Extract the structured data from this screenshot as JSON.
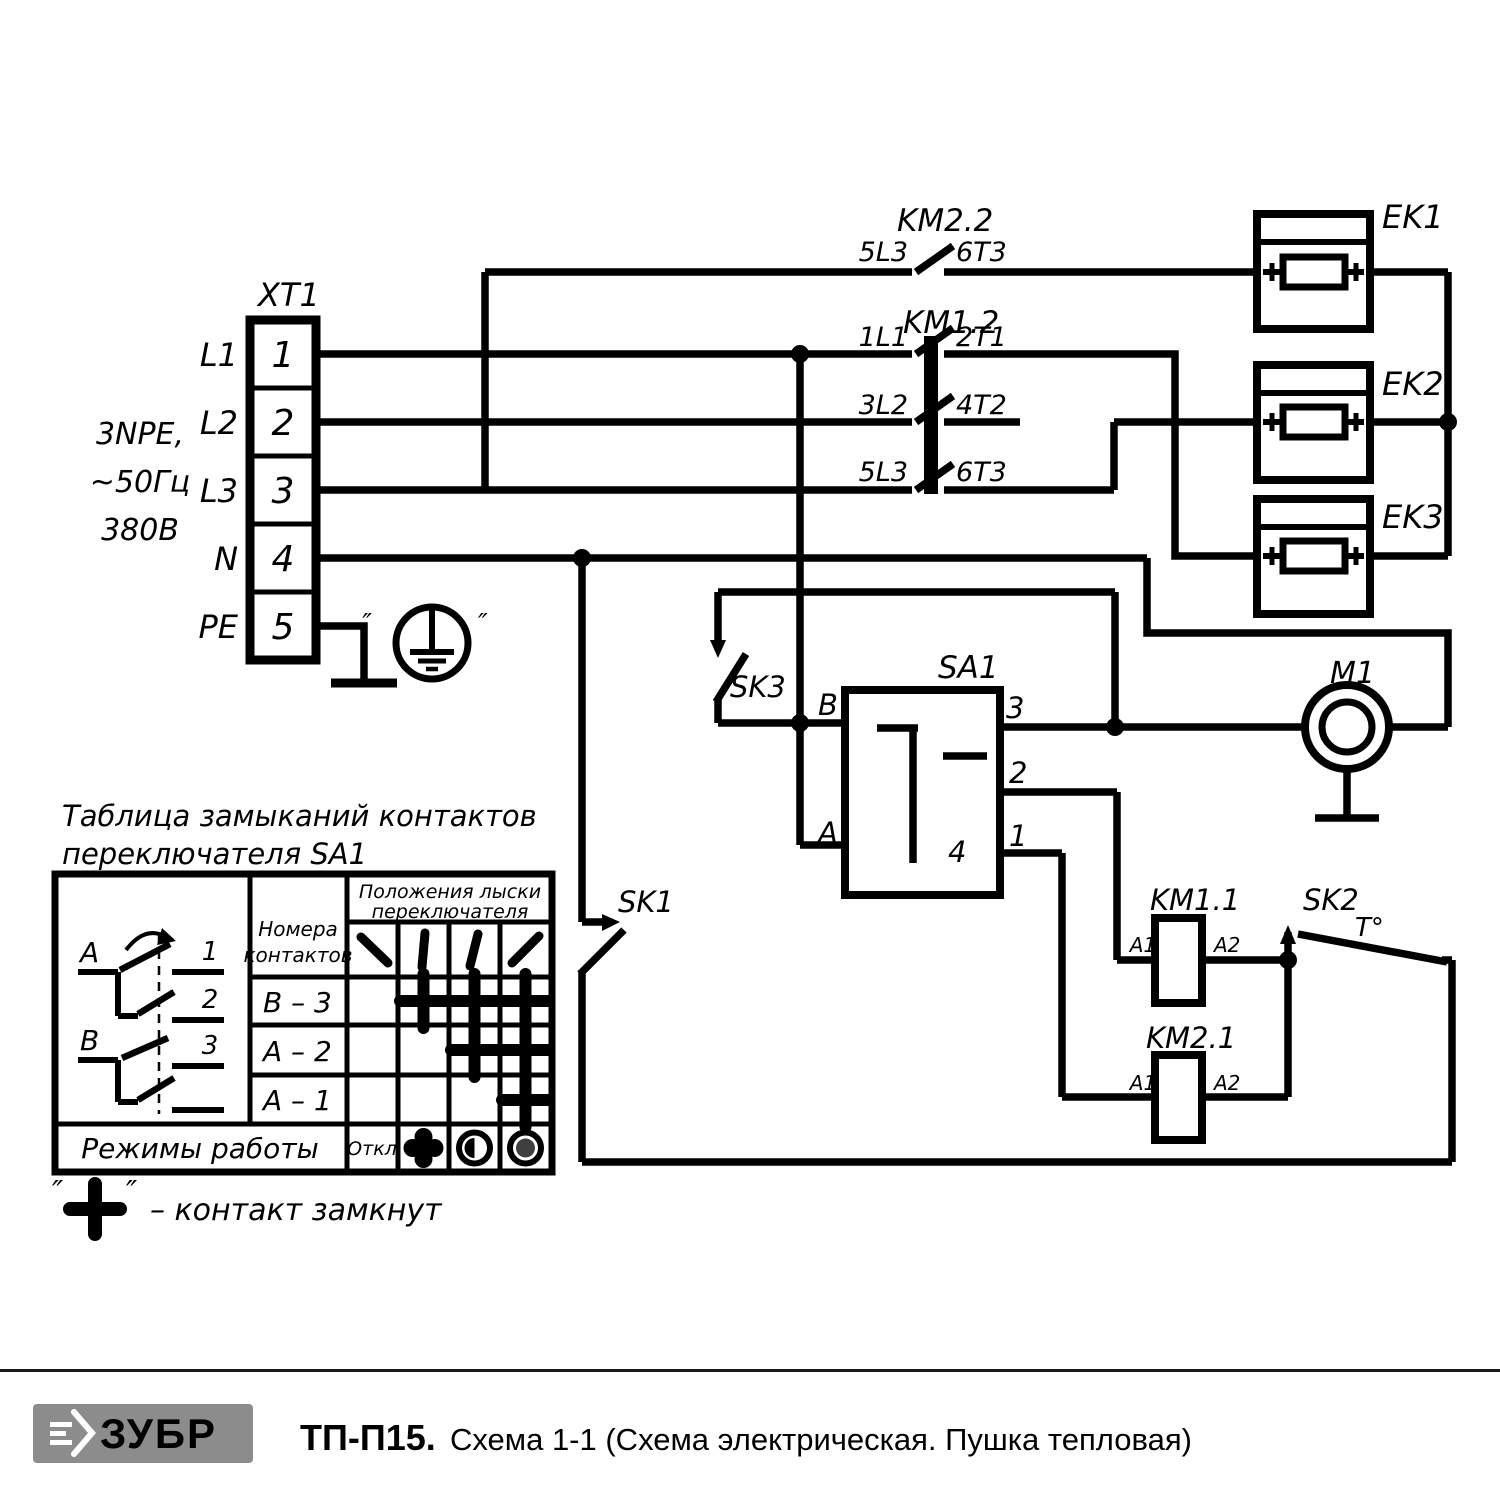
{
  "page": {
    "bg": "#ffffff",
    "ink": "#000000"
  },
  "supply": {
    "line1": "3NPE,",
    "line2": "~50Гц",
    "line3": "380В"
  },
  "xt1": {
    "name": "XT1",
    "numbers": [
      "1",
      "2",
      "3",
      "4",
      "5"
    ],
    "labels": [
      "L1",
      "L2",
      "L3",
      "N",
      "PE"
    ]
  },
  "ground": {
    "quote_open": "″",
    "quote_close": "″"
  },
  "km22": {
    "name": "KM2.2",
    "in": "5L3",
    "out": "6T3"
  },
  "km12": {
    "name": "KM1.2",
    "rows": [
      {
        "in": "1L1",
        "out": "2T1"
      },
      {
        "in": "3L2",
        "out": "4T2"
      },
      {
        "in": "5L3",
        "out": "6T3"
      }
    ]
  },
  "heaters": {
    "ek1": "EK1",
    "ek2": "EK2",
    "ek3": "EK3"
  },
  "sa1": {
    "name": "SA1",
    "b": "B",
    "a": "A",
    "t3": "3",
    "t2": "2",
    "t1": "1",
    "t4": "4"
  },
  "switches": {
    "sk1": "SK1",
    "sk2": "SK2",
    "sk2_temp": "T°",
    "sk3": "SK3"
  },
  "motor": {
    "name": "M1"
  },
  "km11": {
    "name": "KM1.1",
    "a1": "A1",
    "a2": "A2"
  },
  "km21": {
    "name": "KM2.1",
    "a1": "A1",
    "a2": "A2"
  },
  "table": {
    "title1": "Таблица замыканий контактов",
    "title2": "переключателя SA1",
    "contacts_header1": "Номера",
    "contacts_header2": "контактов",
    "positions_header1": "Положения лыски",
    "positions_header2": "переключателя",
    "rows": [
      {
        "label": "B – 3",
        "closed_positions": [
          2,
          3,
          4
        ]
      },
      {
        "label": "A – 2",
        "closed_positions": [
          3,
          4
        ]
      },
      {
        "label": "A – 1",
        "closed_positions": [
          4
        ]
      }
    ],
    "modes_label": "Режимы работы",
    "mode_off": "Откл",
    "diagram": {
      "a": "A",
      "b": "B",
      "n1": "1",
      "n2": "2",
      "n3": "3"
    },
    "note_quote_open": "″",
    "note_quote_close": "″",
    "note_text": "– контакт замкнут"
  },
  "footer": {
    "logo_text": "ЗУБР",
    "model": "ТП-П15.",
    "caption": "Схема 1-1 (Схема электрическая. Пушка тепловая)"
  }
}
